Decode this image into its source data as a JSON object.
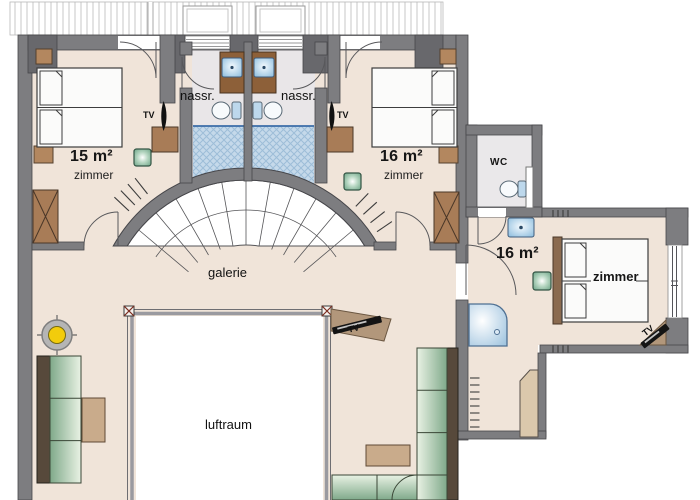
{
  "plan": {
    "labels": {
      "bedroom_left_area": "15 m²",
      "bedroom_left_type": "zimmer",
      "bedroom_topright_area": "16 m²",
      "bedroom_topright_type": "zimmer",
      "bathroom_left": "nassr.",
      "bathroom_right": "nassr.",
      "wc": "WC",
      "bedroom_right_area": "16 m²",
      "bedroom_right_type": "zimmer",
      "gallery": "galerie",
      "void": "luftraum",
      "tv": "TV"
    },
    "colors": {
      "floor": "#f0e4d9",
      "wet_room_floor": "#e9e6e8",
      "wall": "#7d7d80",
      "wall_pier": "#68686c",
      "wood": "#a87c57",
      "sofa_green": "#8fb795",
      "shower_blue": "#c5d9ea",
      "lamp_green": "#74a98c",
      "light_yellow": "#f2cc0c",
      "tv_black": "#141414"
    }
  }
}
